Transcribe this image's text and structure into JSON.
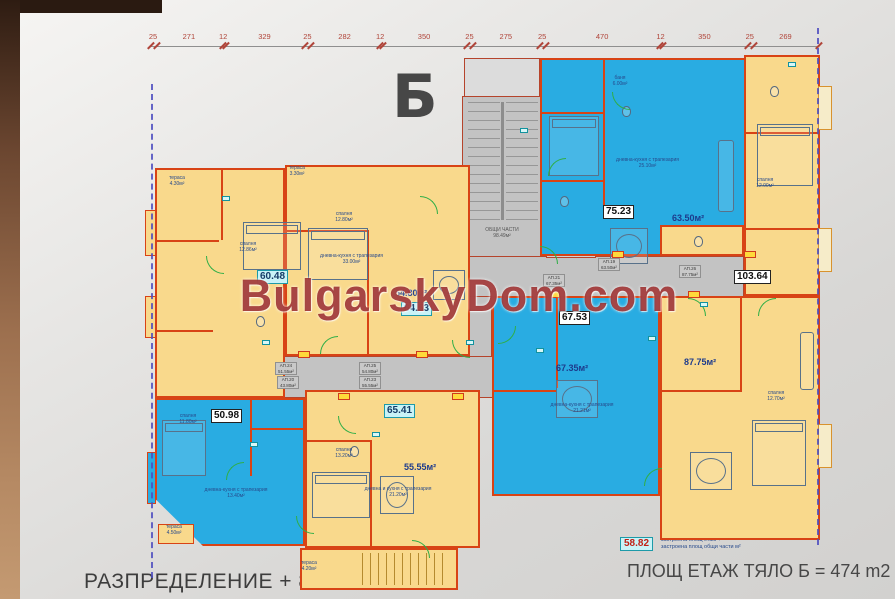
{
  "header": {
    "block_letter": "Б"
  },
  "watermark": "BulgarskyDom.com",
  "dimension_line": {
    "values": [
      "25",
      "271",
      "12",
      "329",
      "25",
      "282",
      "12",
      "350",
      "25",
      "275",
      "25",
      "470",
      "12",
      "350",
      "25",
      "269"
    ]
  },
  "common_area": {
    "title": "ОБЩИ ЧАСТИ",
    "area": "98.49м²"
  },
  "apartments": {
    "a60": {
      "label": "60.48"
    },
    "a75": {
      "label": "75.23",
      "area": "63.50м²"
    },
    "a103": {
      "label": "103.64"
    },
    "a64": {
      "label": "64.53",
      "area": "54.80м²"
    },
    "a67": {
      "label": "67.53",
      "area": "67.35м²"
    },
    "a87": {
      "area": "87.75м²"
    },
    "a50": {
      "label": "50.98"
    },
    "a65": {
      "label": "65.41",
      "area": "55.55м²"
    }
  },
  "corridor_labels": [
    {
      "no": "АП.19",
      "area": "63.50м²"
    },
    {
      "no": "АП.21",
      "area": "67.35м²"
    },
    {
      "no": "АП.26",
      "area": "87.75м²"
    },
    {
      "no": "АП.24",
      "area": "51.55м²"
    },
    {
      "no": "АП.20",
      "area": "43.80м²"
    },
    {
      "no": "АП.25",
      "area": "54.80м²"
    },
    {
      "no": "АП.23",
      "area": "55.55м²"
    }
  ],
  "rooms": [
    {
      "name": "тераса",
      "area": "4.30м²"
    },
    {
      "name": "спалня",
      "area": "12.86м²"
    },
    {
      "name": "тераса",
      "area": "3.30м²"
    },
    {
      "name": "спалня",
      "area": "12.80м²"
    },
    {
      "name": "дневна-кухня с трапезария",
      "area": "33.00м²"
    },
    {
      "name": "баня",
      "area": "6.00м²"
    },
    {
      "name": "дневна-кухня с трапезария",
      "area": "25.10м²"
    },
    {
      "name": "спалня",
      "area": "11.80м²"
    },
    {
      "name": "дневна-кухня с трапезария",
      "area": "13.40м²"
    },
    {
      "name": "спалня",
      "area": "13.20м²"
    },
    {
      "name": "дневна и кухня с трапезария",
      "area": "21.20м²"
    },
    {
      "name": "дневна-кухня с трапезария",
      "area": "21.21м²"
    },
    {
      "name": "спалня",
      "area": "12.00м²"
    },
    {
      "name": "тераса",
      "area": "4.20м²"
    },
    {
      "name": "спалня",
      "area": "12.70м²"
    },
    {
      "name": "тераса",
      "area": "4.50м²"
    }
  ],
  "legend": {
    "value": "58.82",
    "line1": "застроена площ етаж +",
    "line2": "застроена площ общи части м²"
  },
  "footer": {
    "left_caption": "РАЗПРЕДЕЛЕНИЕ + 8.55",
    "right_caption": "ПЛОЩ ЕТАЖ ТЯЛО Б = 474 m2"
  },
  "colors": {
    "apartment_yellow": "#f9d98c",
    "apartment_blue": "#29ace2",
    "wall_red": "#d84315",
    "corridor_gray": "#c3c3c3",
    "watermark_red": "#941d1d",
    "dimension_red": "#b0453a",
    "boundary_blue": "#4d4dc0"
  }
}
